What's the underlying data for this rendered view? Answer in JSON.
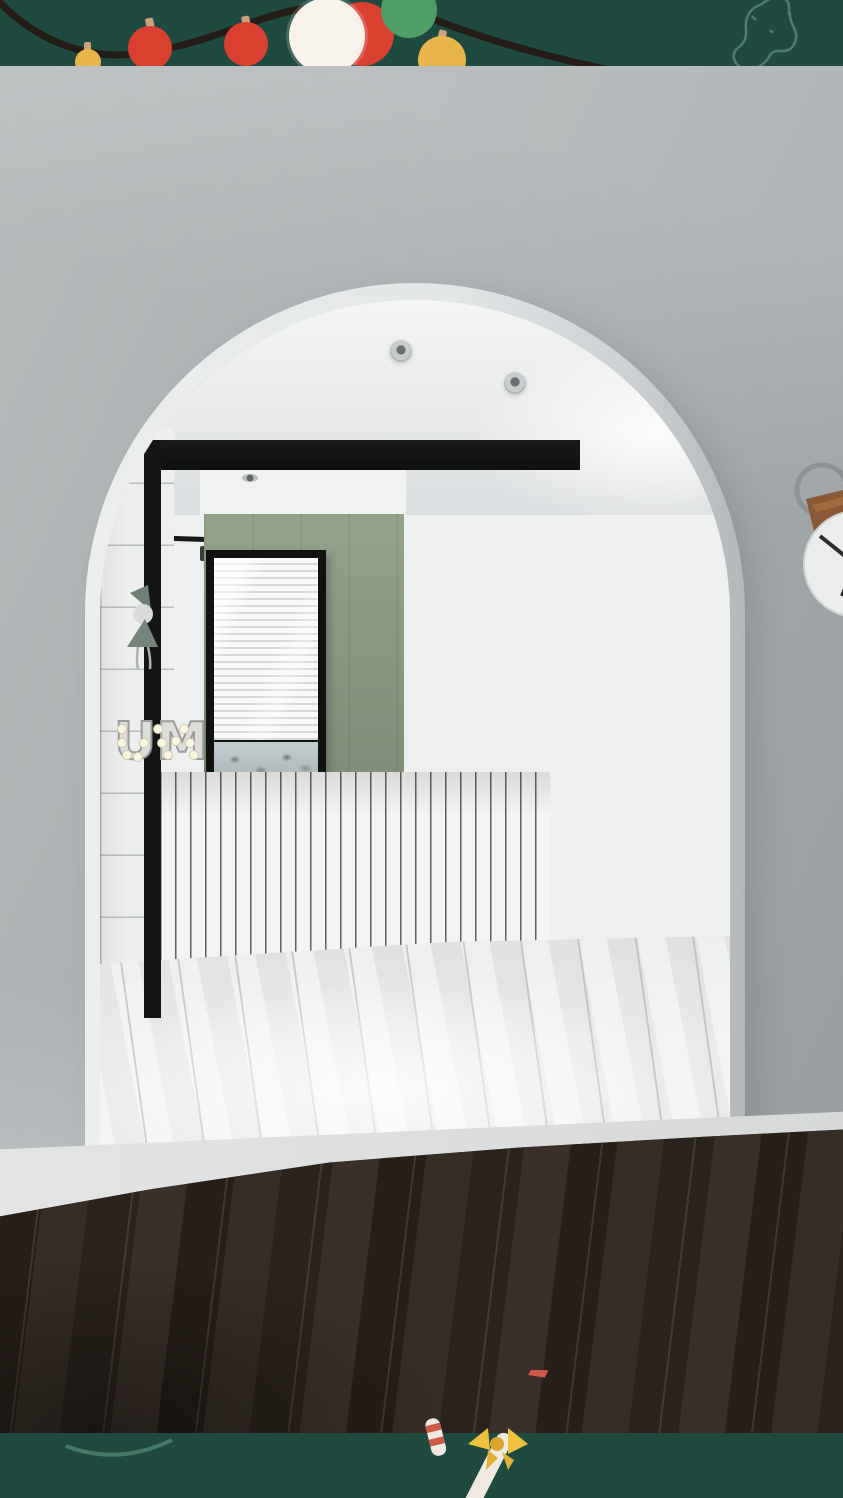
{
  "scene": {
    "title": "Bathroom behind white arched opening with festive overlay",
    "description": "3D interior render: white arch opening into a small bathroom with green accent wall, glass-block shower partition, backlit round mirror, olive vanity, wall-hung toilet, geometric rug; dark wood floor foreground; dark-green holiday strips with string lights, stocking and candy cane.",
    "niche_marquee_letters": "UM"
  },
  "overlay": {
    "top_strip": {
      "color": "#1e4a40",
      "decorations": [
        "string-lights-wire",
        "bauble-red",
        "bauble-red-2",
        "bauble-white",
        "bauble-green",
        "bauble-yellow",
        "bauble-yellow-small",
        "stocking-outline"
      ]
    },
    "bottom_strip": {
      "color": "#1e4a40",
      "decorations": [
        "candy-cane-large",
        "candy-cane-bow",
        "candy-cane-small",
        "swoosh-line"
      ]
    }
  },
  "room": {
    "objects": [
      "arched-opening",
      "recessed-spotlights",
      "green-accent-wall",
      "venetian-blind-window",
      "glass-block-partition",
      "black-door-frame",
      "open-black-door",
      "white-vertical-tile-wainscot",
      "backlit-round-mirror",
      "magnifying-mirror",
      "olive-vanity-cabinet",
      "white-stone-counter",
      "dried-branches",
      "black-lantern",
      "half-wall-with-niches",
      "doll-figurine",
      "marquee-letter-light",
      "wall-hung-toilet",
      "flush-plate",
      "wood-stool",
      "black-side-table",
      "plaid-box",
      "white-pedal-bin",
      "towel-rack-with-towels",
      "wall-poster",
      "geometric-rug",
      "wall-clock-leather-strap",
      "white-plank-bathroom-floor",
      "dark-wood-floor"
    ],
    "palette": {
      "strip_green": "#1e4a40",
      "wall_gray": "#a9aeb0",
      "accent_sage": "#8a9a84",
      "tile_white": "#f3f3f1",
      "vanity_olive": "#3d4531",
      "wood_floor": "#2c241e",
      "bauble_red": "#d9402f",
      "bauble_green": "#4f9e68",
      "bauble_yellow": "#e8b54a",
      "candy_red": "#d05848",
      "bow_yellow": "#eec23f",
      "clock_strap_brown": "#8a5a36"
    }
  }
}
